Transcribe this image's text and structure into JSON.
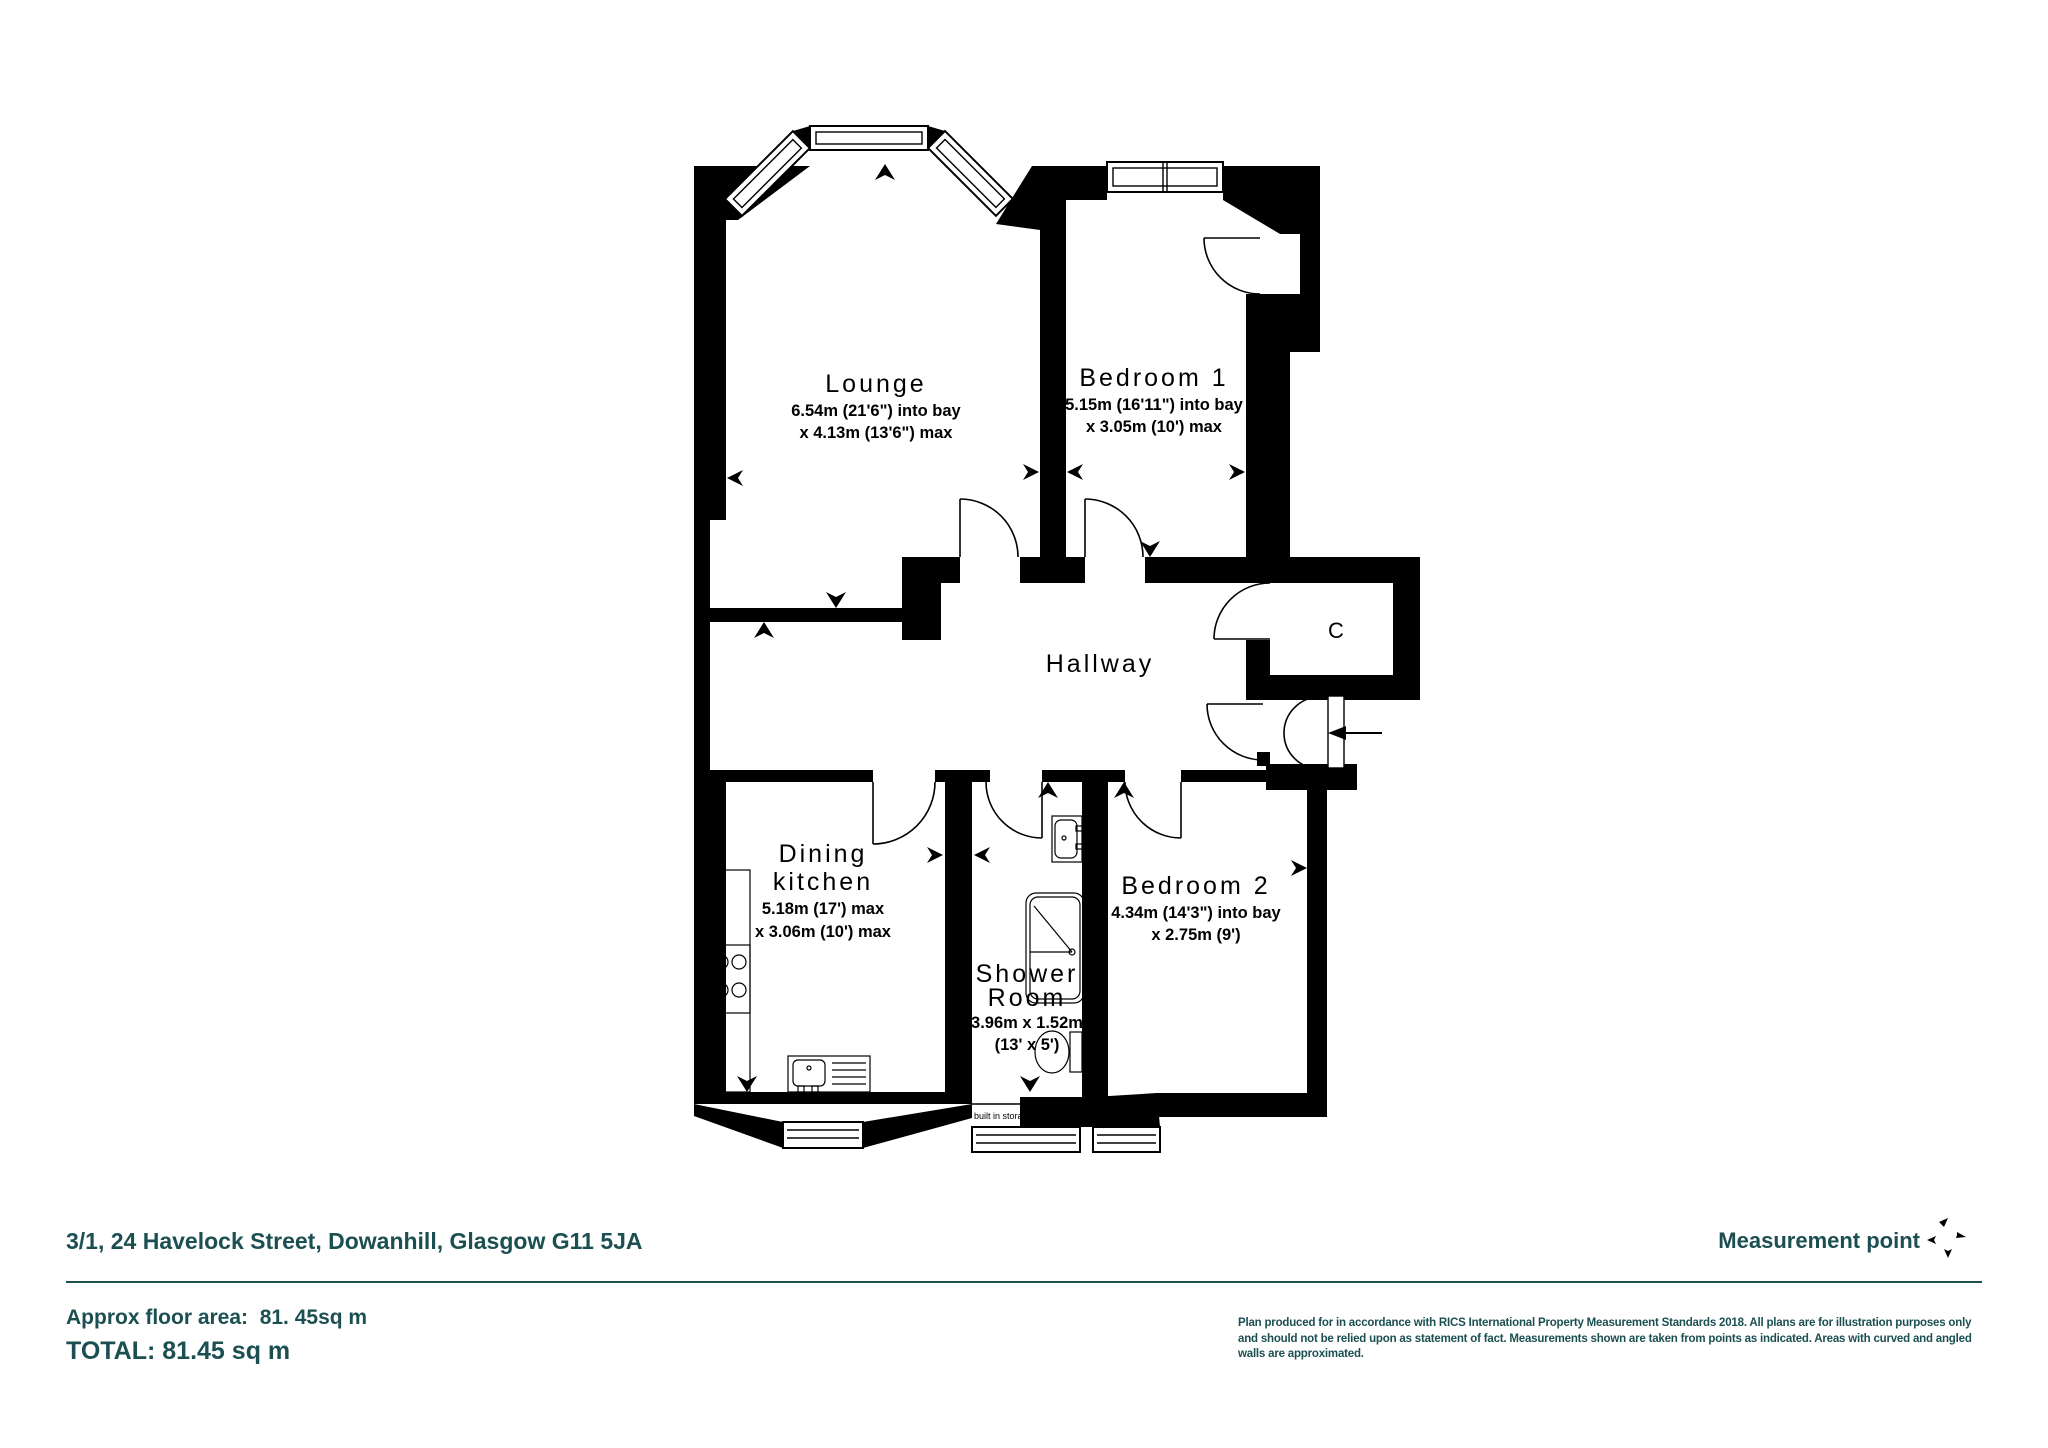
{
  "plan": {
    "rooms": {
      "lounge": {
        "name": "Lounge",
        "dim1": "6.54m (21'6\") into bay",
        "dim2": "x 4.13m (13'6\") max"
      },
      "bedroom1": {
        "name": "Bedroom 1",
        "dim1": "5.15m (16'11\") into bay",
        "dim2": "x 3.05m (10') max"
      },
      "hallway": {
        "name": "Hallway"
      },
      "cupboard": {
        "name": "C"
      },
      "kitchen": {
        "name1": "Dining",
        "name2": "kitchen",
        "dim1": "5.18m (17') max",
        "dim2": "x 3.06m (10') max"
      },
      "shower": {
        "name1": "Shower",
        "name2": "Room",
        "dim1": "3.96m x 1.52m",
        "dim2": "(13' x 5')"
      },
      "bedroom2": {
        "name": "Bedroom 2",
        "dim1": "4.34m (14'3\") into bay",
        "dim2": "x 2.75m (9')"
      },
      "storage": {
        "label": "built in storage"
      }
    }
  },
  "footer": {
    "address": "3/1, 24 Havelock Street, Dowanhill, Glasgow G11 5JA",
    "measurement_point_label": "Measurement point",
    "approx_area": "Approx floor area:  81. 45sq m",
    "total": "TOTAL: 81.45 sq m",
    "disclaimer_line1": "Plan produced for in accordance with RICS International Property Measurement Standards 2018.  All plans are for illustration purposes only",
    "disclaimer_line2": "and should not be relied upon as statement of fact. Measurements shown are taken from points as indicated. Areas with curved and angled",
    "disclaimer_line3": "walls are approximated."
  },
  "colors": {
    "accent_teal": "#1b4f52",
    "plan_ink": "#000000"
  }
}
